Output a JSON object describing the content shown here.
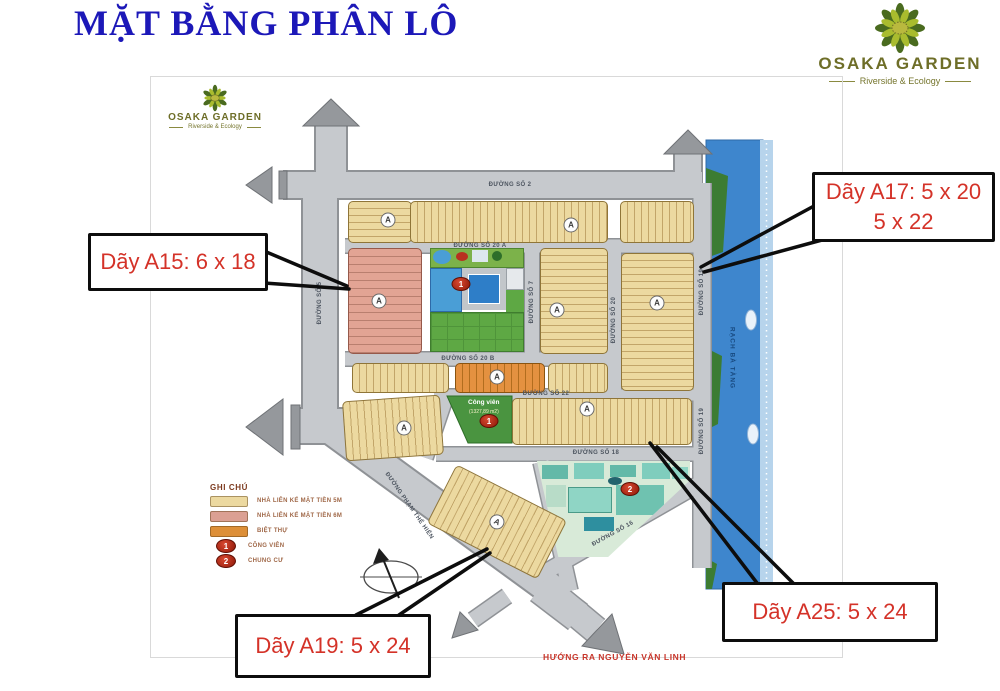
{
  "header": {
    "title": "MẶT BẰNG PHÂN LÔ"
  },
  "brand": {
    "name": "OSAKA GARDEN",
    "tagline": "Riverside & Ecology"
  },
  "callouts": {
    "a15": "Dãy A15: 6 x 18",
    "a17_line1": "Dãy A17: 5 x 20",
    "a17_line2": "5 x 22",
    "a25": "Dãy A25: 5 x 24",
    "a19": "Dãy A19: 5 x 24"
  },
  "legend": {
    "title": "GHI CHÚ",
    "items": [
      {
        "label": "NHÀ LIÊN KẾ MẶT TIỀN 5M"
      },
      {
        "label": "NHÀ LIÊN KẾ MẶT TIỀN 6M"
      },
      {
        "label": "BIỆT THỰ"
      },
      {
        "marker": "1",
        "label": "CÔNG VIÊN"
      },
      {
        "marker": "2",
        "label": "CHUNG CƯ"
      }
    ]
  },
  "map": {
    "streets": {
      "so2": "ĐƯỜNG SỐ 2",
      "so20a": "ĐƯỜNG SỐ 20 A",
      "so20b": "ĐƯỜNG SỐ 20 B",
      "so22": "ĐƯỜNG SỐ 22",
      "so18": "ĐƯỜNG SỐ 18",
      "so16": "ĐƯỜNG SỐ 16",
      "so5": "ĐƯỜNG SỐ 5",
      "so7": "ĐƯỜNG SỐ 7",
      "so20": "ĐƯỜNG SỐ 20",
      "so19": "ĐƯỜNG SỐ 19",
      "pham_the_hien": "ĐƯỜNG PHẠM THẾ HIỂN"
    },
    "river": "RẠCH BÀ TÀNG",
    "park_name": "Công viên",
    "park_area": "(1327,89 m2)",
    "block_badge": "A",
    "marker_park": "1",
    "marker_apartment": "2",
    "exit": "HƯỚNG RA NGUYỄN VĂN LINH"
  },
  "colors": {
    "title_blue": "#1c18b8",
    "callout_red": "#d43228",
    "road_gray": "#c6c9cd",
    "lot_5m_tan": "#ecd9a0",
    "lot_6m_salmon": "#e2a494",
    "villa_orange": "#e49140",
    "river_blue": "#3e86cd",
    "park_green": "#5ea844",
    "marker_red": "#b22010"
  }
}
